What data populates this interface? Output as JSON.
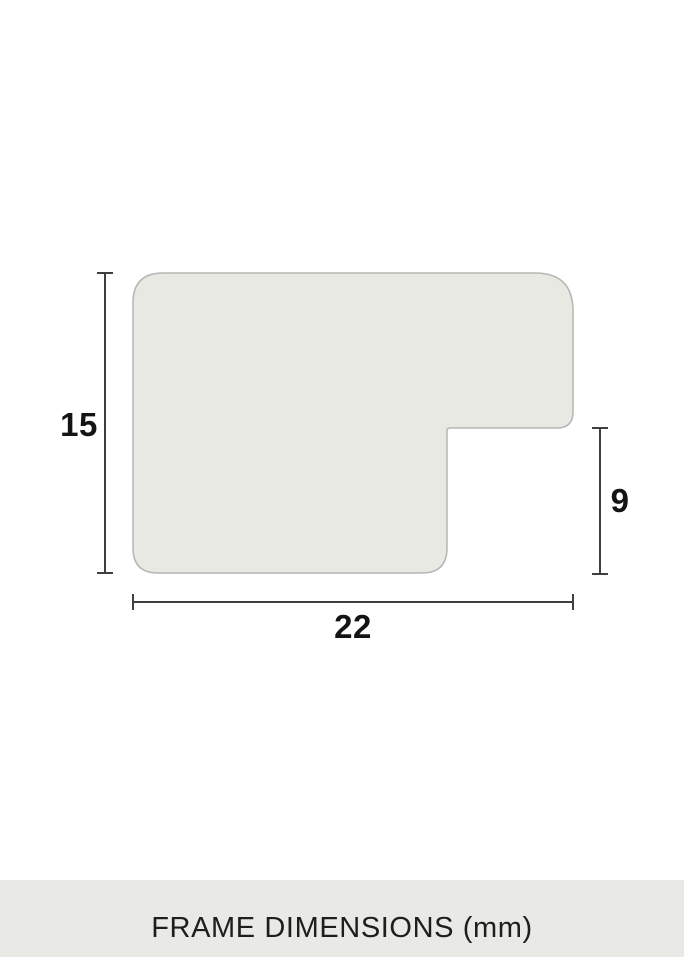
{
  "diagram": {
    "title": "FRAME DIMENSIONS (mm)",
    "unit": "mm",
    "dimensions": {
      "height": {
        "label": "15",
        "value_mm": 15
      },
      "width": {
        "label": "22",
        "value_mm": 22
      },
      "rabbet_height": {
        "label": "9",
        "value_mm": 9
      }
    },
    "colors": {
      "background": "#ffffff",
      "profile_fill": "#e9e9e4",
      "profile_stroke": "#b5b5b1",
      "dimension_line": "#3f3f3d",
      "label_text": "#141414",
      "caption_band_bg": "#e9e9e5",
      "caption_text": "#1e1e1c"
    }
  }
}
